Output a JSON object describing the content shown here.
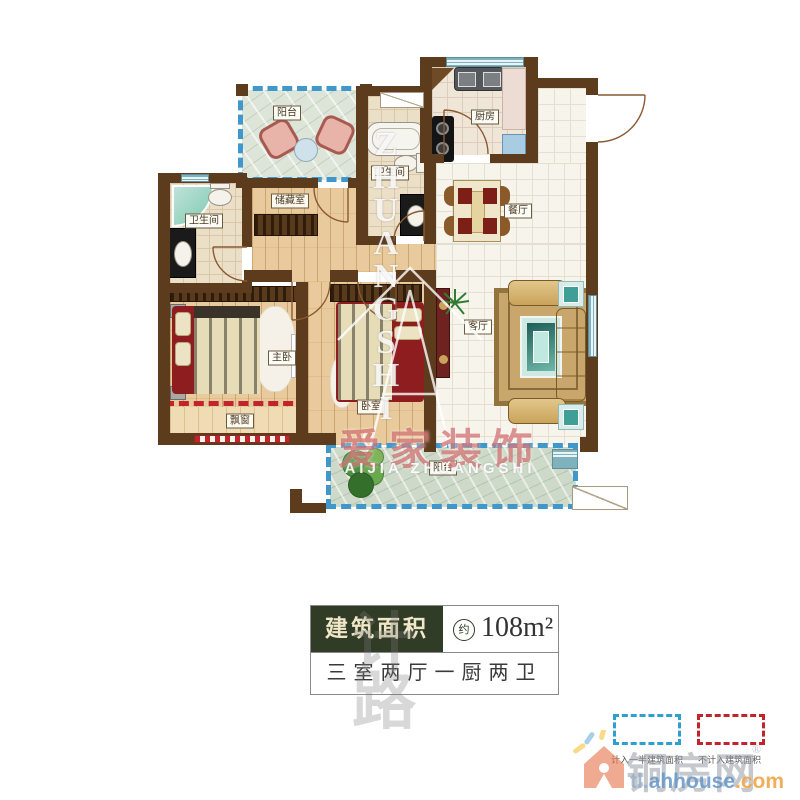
{
  "plan": {
    "rooms": [
      {
        "name": "阳台"
      },
      {
        "name": "厨房"
      },
      {
        "name": "卫生间"
      },
      {
        "name": "卫生间"
      },
      {
        "name": "储藏室"
      },
      {
        "name": "餐厅"
      },
      {
        "name": "客厅"
      },
      {
        "name": "主卧"
      },
      {
        "name": "卧室"
      },
      {
        "name": "飘窗"
      },
      {
        "name": "阳台"
      }
    ],
    "watermark": {
      "letters": "ZHUANGSHI",
      "brand_cn": "爱家装饰",
      "brand_en": "AIJIA ZHUANGSHI",
      "faint_glyphs": [
        "计",
        "路"
      ]
    }
  },
  "info": {
    "area_label": "建筑面积",
    "approx": "约",
    "area_value": "108m²",
    "layout": "三室两厅一厨两卫"
  },
  "legend": {
    "half_area": {
      "label": "计入一半建筑面积",
      "color": "#2e9fd0"
    },
    "excluded": {
      "label": "不计入建筑面积",
      "color": "#c2242c"
    }
  },
  "site": {
    "name": "铜房网",
    "reg": "®",
    "url_left": "tl.",
    "url_mid": "ahhouse",
    "url_right": ".com"
  },
  "colors": {
    "wall": "#5d3c1e",
    "accent_green": "#313c27",
    "half_area_line": "#3f97cc",
    "excluded_line": "#c2242c"
  }
}
